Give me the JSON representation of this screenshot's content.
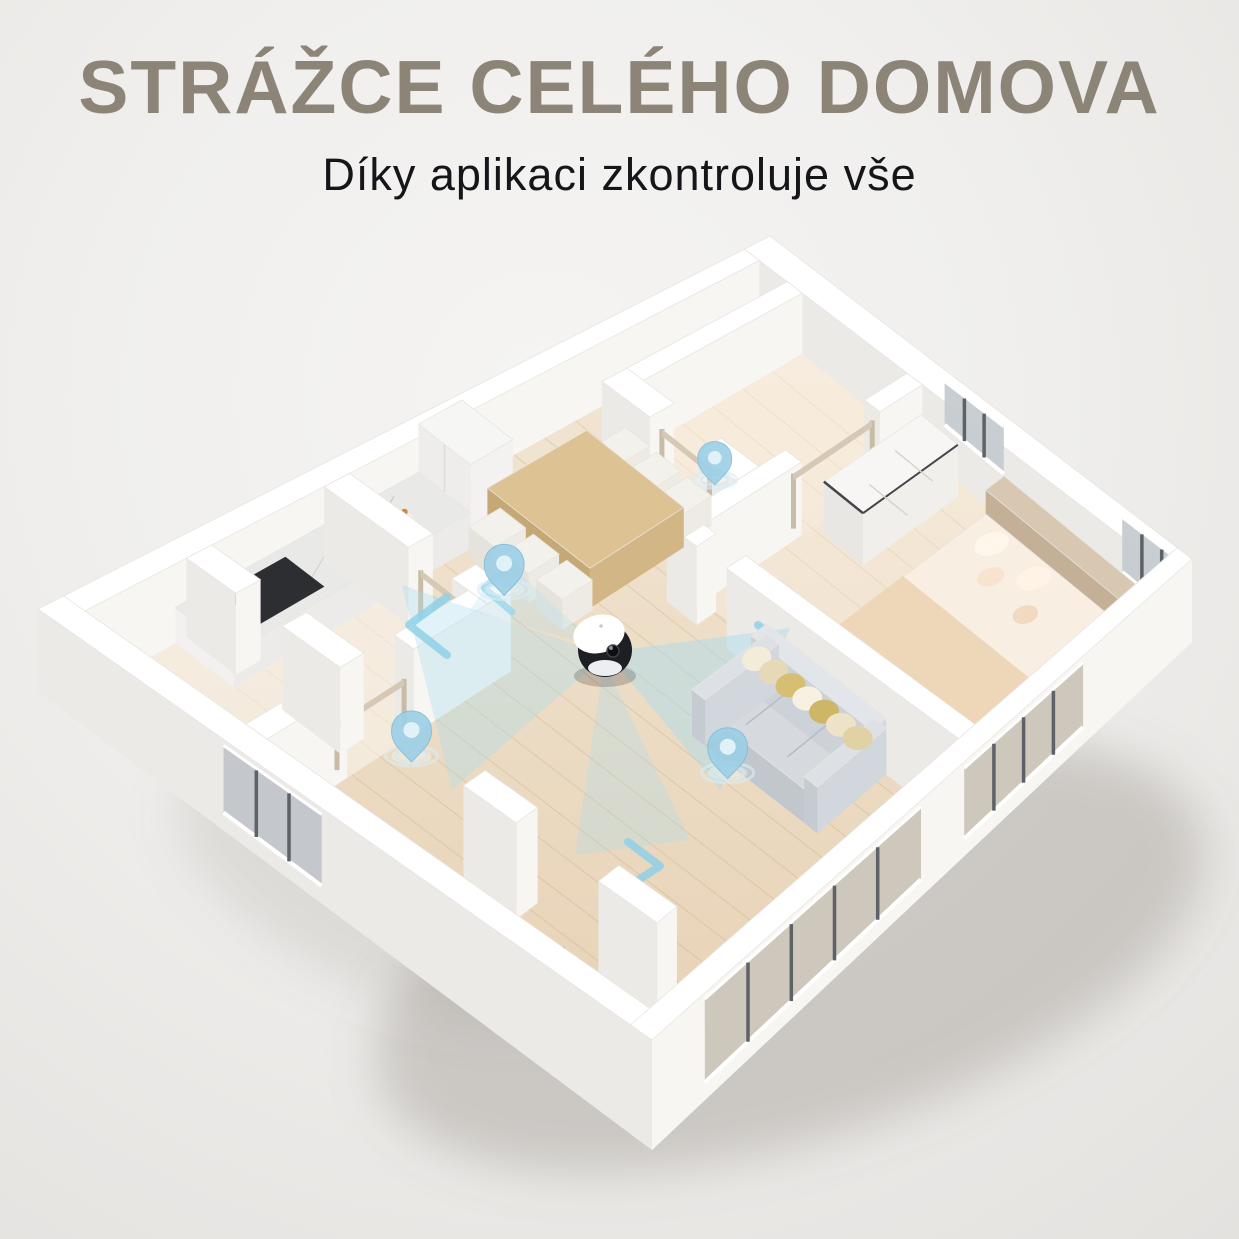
{
  "header": {
    "title": "STRÁŽCE CELÉHO DOMOVA",
    "subtitle": "Díky aplikaci zkontroluje vše"
  },
  "palette": {
    "background": "#f0efed",
    "title": "#8d8478",
    "subtitle": "#15161a",
    "wall": "#ffffff",
    "wall_shade": "#eceae6",
    "floor_wood_light": "#f2e7d6",
    "floor_wood_dark": "#e6d0b2",
    "beam_blue": "#a9dcef",
    "pin_blue": "#9ccfe6",
    "glass_gray": "#c6cbd0",
    "robot_black": "#1d1f24",
    "robot_white": "#ffffff"
  },
  "scene": {
    "type": "isometric-apartment-cutaway",
    "device": "home-security-robot-camera",
    "pin_count": 4,
    "icons": [
      "location-pin-icon",
      "scan-beam",
      "direction-arrow"
    ],
    "rooms_visible": [
      "kitchen",
      "dining-area",
      "living-room",
      "bedroom",
      "hallway",
      "bathroom",
      "balcony"
    ]
  }
}
